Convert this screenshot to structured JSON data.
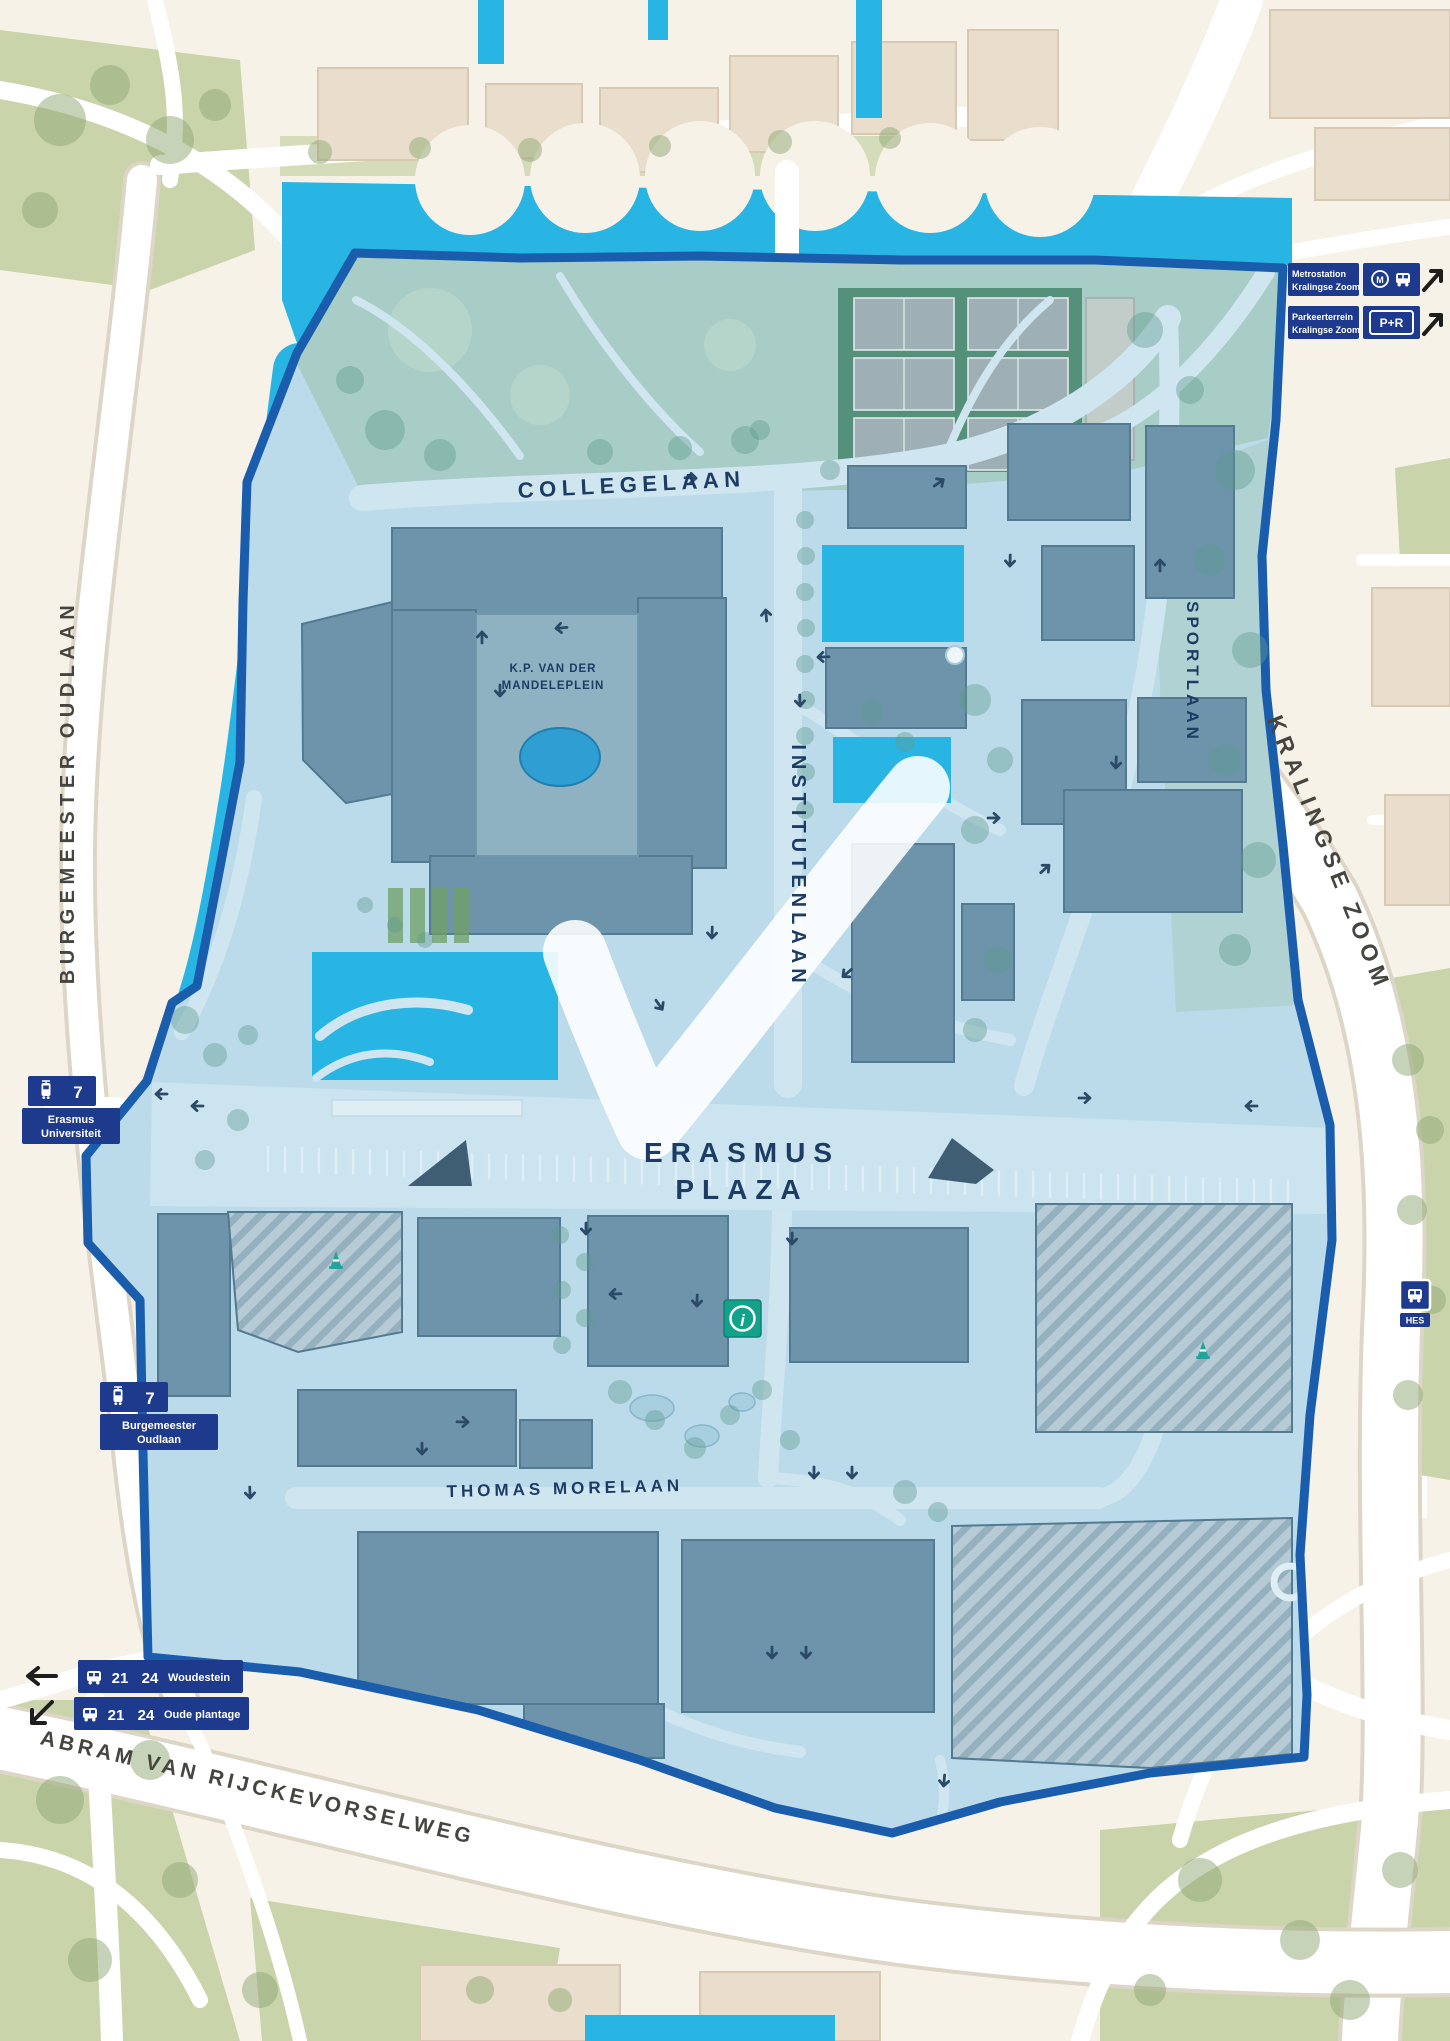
{
  "roads": {
    "burgemeester_oudlaan": "BURGEMEESTER OUDLAAN",
    "kralingse_zoom": "KRALINGSE ZOOM",
    "abram_van_rijckevorselweg": "ABRAM VAN RIJCKEVORSELWEG",
    "collegelaan": "COLLEGELAAN",
    "institutenlaan": "INSTITUTENLAAN",
    "sportlaan": "SPORTLAAN",
    "thomas_morelaan": "THOMAS MORELAAN"
  },
  "places": {
    "erasmus_plaza": {
      "line1": "ERASMUS",
      "line2": "PLAZA"
    },
    "mandeleplein": {
      "line1": "K.P. VAN DER",
      "line2": "MANDELEPLEIN"
    }
  },
  "transit": {
    "metro_station_badge": {
      "line1": "Metrostation",
      "line2": "Kralingse Zoom"
    },
    "pr_badge": {
      "line1": "Parkeerterrein",
      "line2": "Kralingse Zoom",
      "chip": "P+R"
    },
    "tram_stop_university": {
      "line_number": "7",
      "name_line1": "Erasmus",
      "name_line2": "Universiteit"
    },
    "tram_stop_oudlaan": {
      "line_number": "7",
      "name_line1": "Burgemeester",
      "name_line2": "Oudlaan"
    },
    "bus_stop_woudestein": {
      "line_a": "21",
      "line_b": "24",
      "name": "Woudestein"
    },
    "bus_stop_oude_plantage": {
      "line_a": "21",
      "line_b": "24",
      "name": "Oude plantage"
    },
    "bus_stop_hes": {
      "name": "HES"
    }
  },
  "symbols": {
    "info": "i",
    "metro_m": "M"
  },
  "colors": {
    "water": "#29b5e4",
    "campus_fill": "#bcdbea",
    "campus_border": "#1a5dad",
    "building": "#6d94aa",
    "badge_navy": "#1e3a8c",
    "info_green": "#12a28b",
    "label_navy": "#1c3c64",
    "ground_beige": "#f7f2e8",
    "block_beige": "#e9decb",
    "green_area": "#c9d4ab",
    "court_green": "#55907a"
  }
}
